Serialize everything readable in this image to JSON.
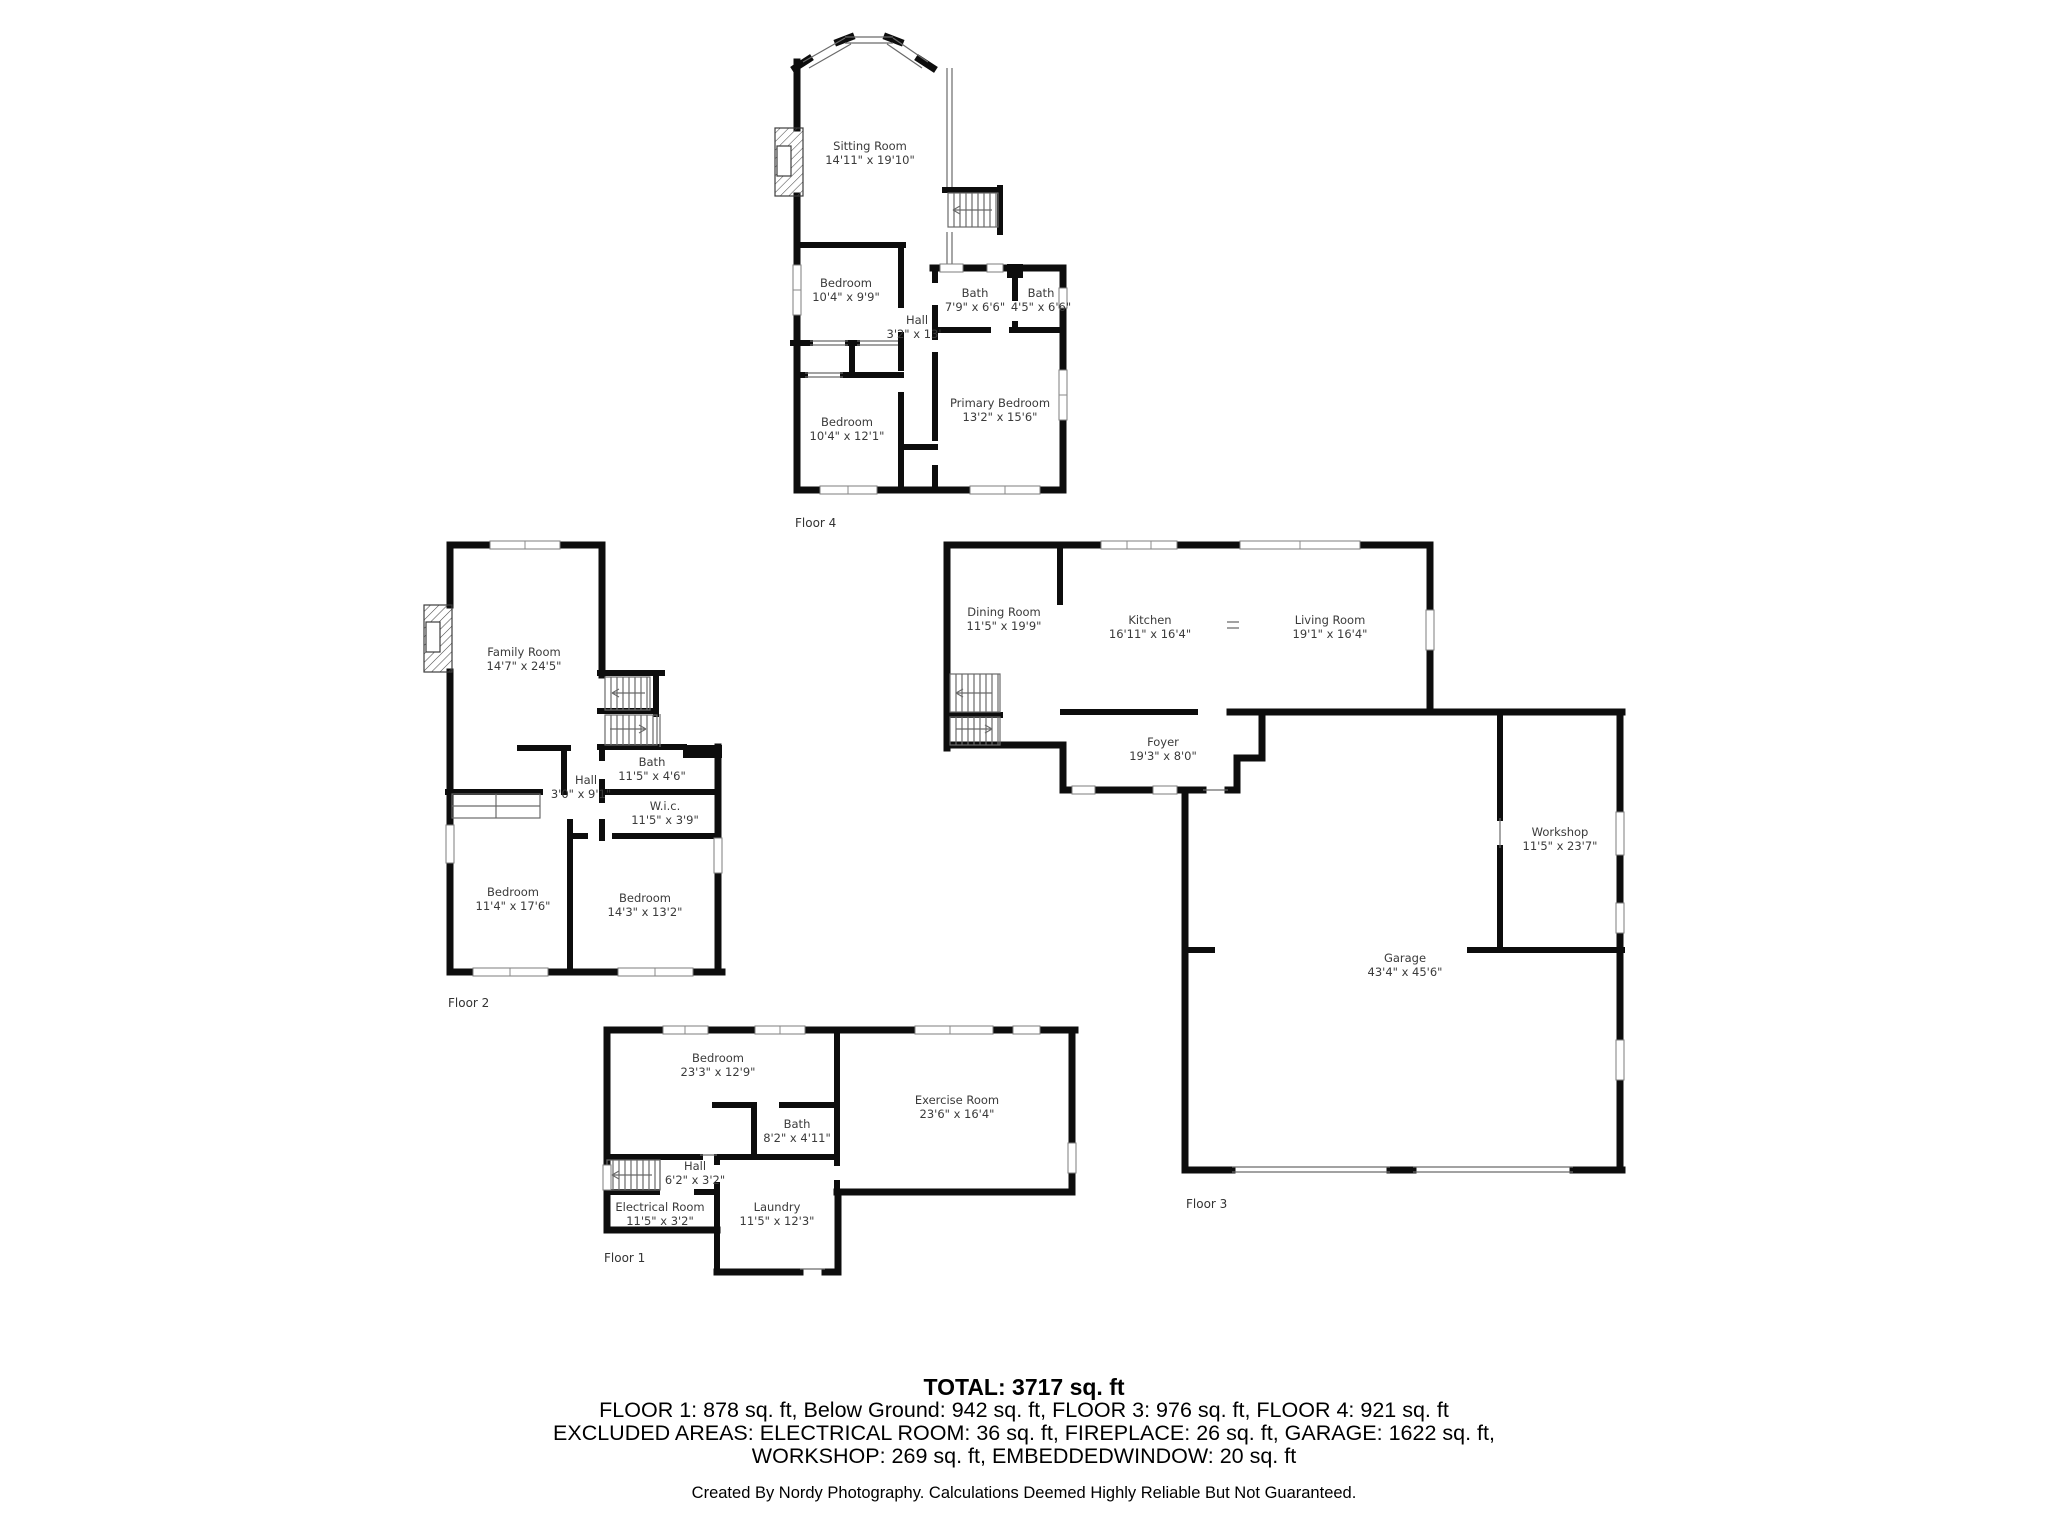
{
  "floors": [
    {
      "id": "floor-1",
      "label": "Floor 1",
      "rooms": [
        {
          "name": "Bedroom",
          "dims": "23'3\" x 12'9\""
        },
        {
          "name": "Exercise Room",
          "dims": "23'6\" x 16'4\""
        },
        {
          "name": "Bath",
          "dims": "8'2\" x 4'11\""
        },
        {
          "name": "Hall",
          "dims": "6'2\" x 3'2\""
        },
        {
          "name": "Electrical Room",
          "dims": "11'5\" x 3'2\""
        },
        {
          "name": "Laundry",
          "dims": "11'5\" x 12'3\""
        }
      ]
    },
    {
      "id": "floor-2",
      "label": "Floor 2",
      "rooms": [
        {
          "name": "Family Room",
          "dims": "14'7\" x 24'5\""
        },
        {
          "name": "Bath",
          "dims": "11'5\" x 4'6\""
        },
        {
          "name": "W.i.c.",
          "dims": "11'5\" x 3'9\""
        },
        {
          "name": "Hall",
          "dims": "3'0\" x 9'1\""
        },
        {
          "name": "Bedroom",
          "dims": "11'4\" x 17'6\""
        },
        {
          "name": "Bedroom",
          "dims": "14'3\" x 13'2\""
        }
      ]
    },
    {
      "id": "floor-3",
      "label": "Floor 3",
      "rooms": [
        {
          "name": "Dining Room",
          "dims": "11'5\" x 19'9\""
        },
        {
          "name": "Kitchen",
          "dims": "16'11\" x 16'4\""
        },
        {
          "name": "Living Room",
          "dims": "19'1\" x 16'4\""
        },
        {
          "name": "Foyer",
          "dims": "19'3\" x 8'0\""
        },
        {
          "name": "Workshop",
          "dims": "11'5\" x 23'7\""
        },
        {
          "name": "Garage",
          "dims": "43'4\" x 45'6\""
        }
      ]
    },
    {
      "id": "floor-4",
      "label": "Floor 4",
      "rooms": [
        {
          "name": "Sitting Room",
          "dims": "14'11\" x 19'10\""
        },
        {
          "name": "Bedroom",
          "dims": "10'4\" x 9'9\""
        },
        {
          "name": "Bath",
          "dims": "7'9\" x 6'6\""
        },
        {
          "name": "Bath",
          "dims": "4'5\" x 6'6\""
        },
        {
          "name": "Hall",
          "dims": "3'2\" x 13'"
        },
        {
          "name": "Primary Bedroom",
          "dims": "13'2\" x 15'6\""
        },
        {
          "name": "Bedroom",
          "dims": "10'4\" x 12'1\""
        }
      ]
    }
  ],
  "summary": {
    "total": "TOTAL: 3717 sq. ft",
    "line1": "FLOOR 1: 878 sq. ft, Below Ground: 942 sq. ft, FLOOR 3: 976 sq. ft, FLOOR 4: 921 sq. ft",
    "line2": "EXCLUDED AREAS: ELECTRICAL ROOM: 36 sq. ft, FIREPLACE: 26 sq. ft, GARAGE: 1622 sq. ft,",
    "line3": "WORKSHOP: 269 sq. ft, EMBEDDEDWINDOW: 20 sq. ft",
    "credit": "Created By Nordy Photography. Calculations Deemed Highly Reliable But Not Guaranteed."
  }
}
